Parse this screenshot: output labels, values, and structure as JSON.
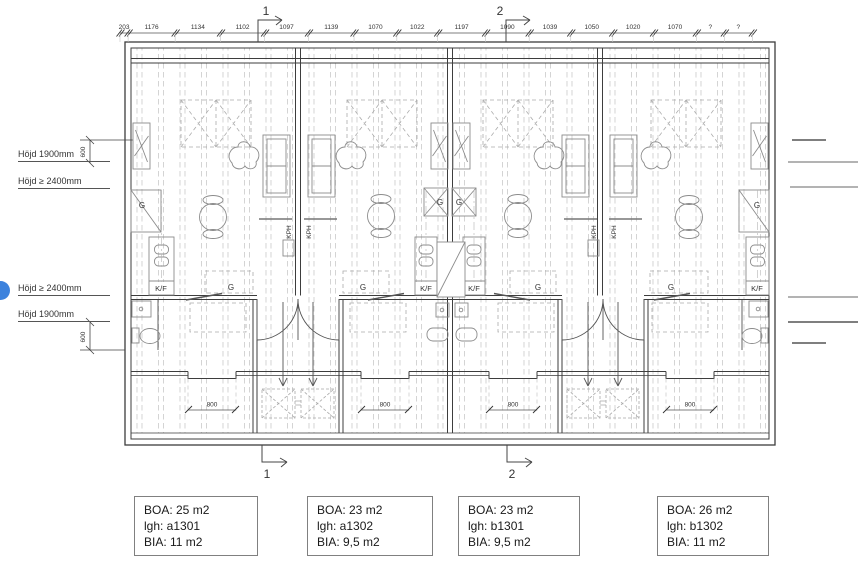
{
  "drawing": {
    "section_markers": {
      "top": [
        "1",
        "2"
      ],
      "bottom": [
        "1",
        "2"
      ]
    },
    "top_dimensions": [
      "203",
      "1176",
      "1134",
      "1102",
      "1097",
      "1139",
      "1070",
      "1022",
      "1197",
      "1090",
      "1039",
      "1050",
      "1020",
      "1070",
      "?",
      "?"
    ],
    "height_labels": {
      "upper": [
        "Höjd 1900mm",
        "Höjd ≥ 2400mm"
      ],
      "lower": [
        "Höjd ≥ 2400mm",
        "Höjd 1900mm"
      ],
      "vertical_dims": [
        "600",
        "600"
      ]
    },
    "plan_labels": {
      "wardrobe": "G",
      "fridge_freezer": "K/F",
      "kph": "KPH",
      "window_width": "800"
    },
    "units": [
      {
        "boa": "BOA: 25 m2",
        "lgh": "lgh: a1301",
        "bia": "BIA: 11 m2"
      },
      {
        "boa": "BOA: 23 m2",
        "lgh": "lgh: a1302",
        "bia": "BIA: 9,5 m2"
      },
      {
        "boa": "BOA: 23 m2",
        "lgh": "lgh: b1301",
        "bia": "BIA: 9,5 m2"
      },
      {
        "boa": "BOA: 26 m2",
        "lgh": "lgh: b1302",
        "bia": "BIA: 11 m2"
      }
    ],
    "badge_color": "#3c82dd"
  }
}
